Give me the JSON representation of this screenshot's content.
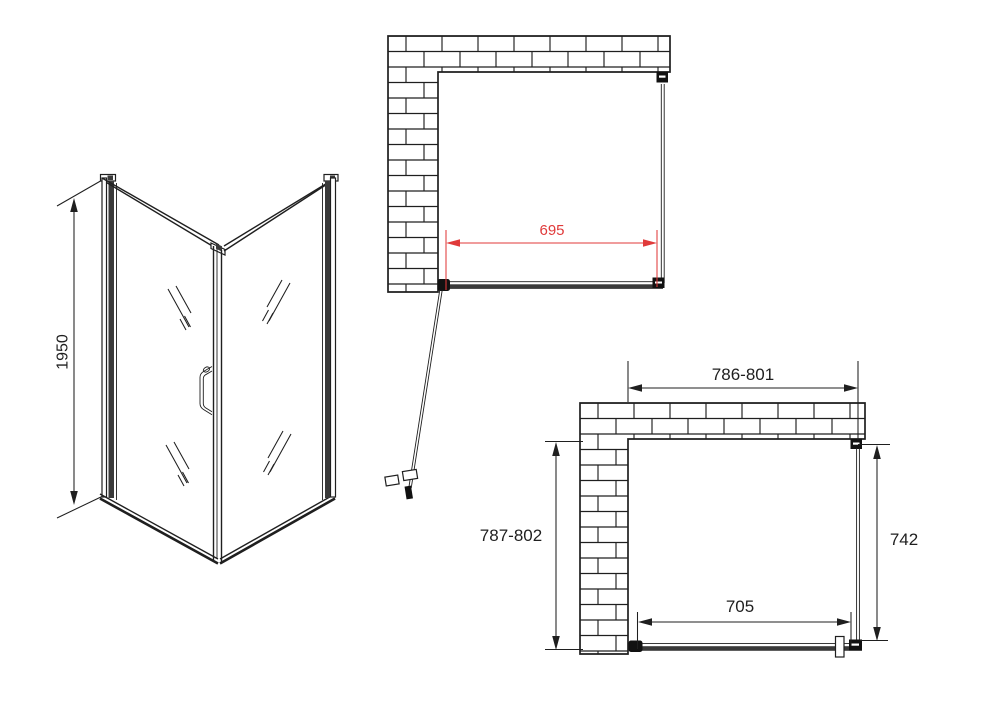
{
  "drawing": {
    "perspective_view": {
      "height_label": "1950"
    },
    "top_plan_view": {
      "door_width_label": "695"
    },
    "side_plan_view": {
      "opening_width_label": "786-801",
      "opening_depth_label": "787-802",
      "panel_depth_label": "742",
      "door_width_label": "705"
    }
  },
  "colors": {
    "line": "#1f1f1f",
    "dark_fill": "#3a3a3a",
    "hinge": "#111111",
    "accent_red": "#e03a3a",
    "background": "#ffffff"
  }
}
